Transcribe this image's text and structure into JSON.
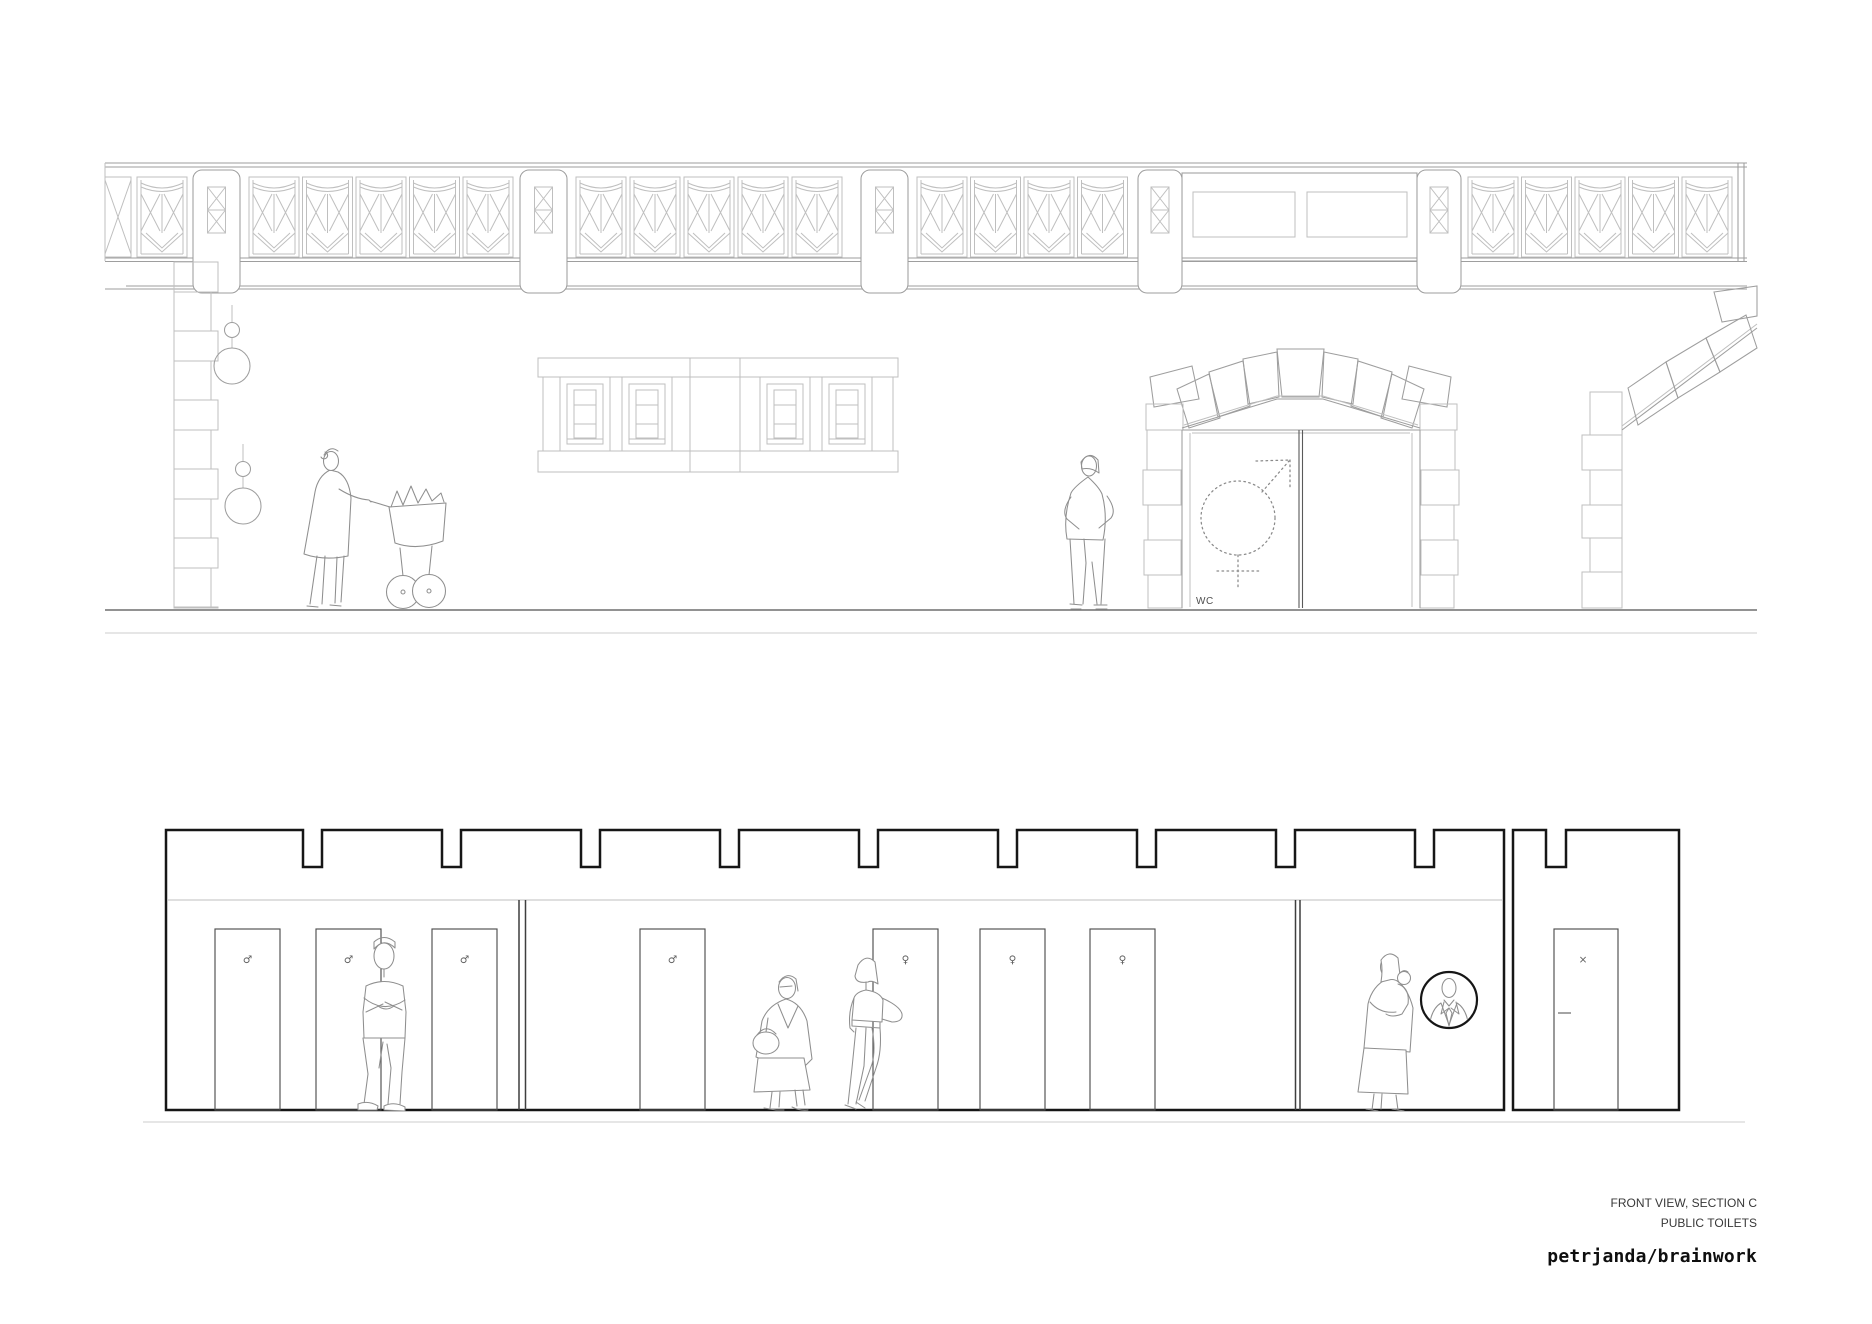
{
  "title_block": {
    "view_title": "FRONT VIEW, SECTION C",
    "project_title": "PUBLIC TOILETS",
    "studio_logo": "petrjanda/brainwork"
  },
  "upper_drawing": {
    "wc_label": "WC",
    "entrance_symbol": "combined-male-female-sign-dotted",
    "bridge": {
      "x1": 105,
      "x2": 1747,
      "rail_ys": [
        163,
        167
      ],
      "deck_lines": [
        [
          258,
          105,
          1747
        ],
        [
          261.5,
          105,
          1747
        ],
        [
          286,
          126,
          1747
        ],
        [
          289,
          105,
          1747
        ]
      ],
      "panel_xs": [
        137,
        249,
        302.5,
        356,
        409.5,
        463,
        576,
        630,
        684,
        738,
        792,
        917,
        970.5,
        1024,
        1077.5,
        1468,
        1521.5,
        1575,
        1628.5,
        1682
      ],
      "pillar_xs": [
        193,
        520,
        861
      ],
      "big_pillar_xs": [
        1138,
        1417
      ],
      "end_post_xs": [
        1738,
        1744
      ],
      "parapet": {
        "x": 1182,
        "w": 235,
        "windows": [
          [
            1193,
            102
          ],
          [
            1307,
            100
          ]
        ],
        "win_y": 192,
        "win_h": 45
      }
    },
    "quoins": {
      "x": 174,
      "top": 262,
      "bottom": 608
    },
    "lamps": [
      {
        "x": 232,
        "small_y": 330,
        "globe_y": 366
      },
      {
        "x": 243,
        "small_y": 469,
        "globe_y": 506
      }
    ],
    "window_box": {
      "x": 538,
      "w": 360,
      "window_xs": [
        560,
        622,
        760,
        822
      ]
    },
    "arch": {
      "center_x": 1300,
      "door_top": 430,
      "door_bottom": 608,
      "symbol_cx": 1238,
      "symbol_cy": 518,
      "symbol_r": 37
    },
    "ground_ys": [
      610,
      633
    ]
  },
  "lower_drawing": {
    "building": {
      "x1": 166,
      "x2": 1504,
      "top": 830,
      "floor": 1110,
      "ceiling_y": 900,
      "notch_xs": [
        303,
        442,
        581,
        720,
        859,
        998,
        1137,
        1276,
        1415
      ],
      "notch_w": 19,
      "notch_d": 37
    },
    "partitions": [
      [
        519,
        525.5
      ],
      [
        1295.5,
        1300
      ]
    ],
    "door_w": 65,
    "door_top": 929,
    "doors": [
      {
        "x": 215,
        "symbol": "♂"
      },
      {
        "x": 316,
        "symbol": "♂"
      },
      {
        "x": 432,
        "symbol": "♂"
      },
      {
        "x": 640,
        "symbol": "♂"
      },
      {
        "x": 873,
        "symbol": "♀"
      },
      {
        "x": 980,
        "symbol": "♀"
      },
      {
        "x": 1090,
        "symbol": "♀"
      }
    ],
    "annex": {
      "x1": 1513,
      "x2": 1679,
      "top": 830,
      "floor": 1110,
      "notch_x": 1546,
      "notch_w": 20,
      "notch_d": 37,
      "door": {
        "x": 1554,
        "w": 64,
        "symbol": "×"
      }
    },
    "ground_y": 1122
  },
  "colors": {
    "background": "#ffffff",
    "line_light": "#bfbfbf",
    "line_mid": "#9e9e9e",
    "line_dark": "#4a4a4a",
    "line_bold": "#161616",
    "figure": "#8f8f8f",
    "text": "#383838",
    "logo": "#0e0e0e"
  }
}
